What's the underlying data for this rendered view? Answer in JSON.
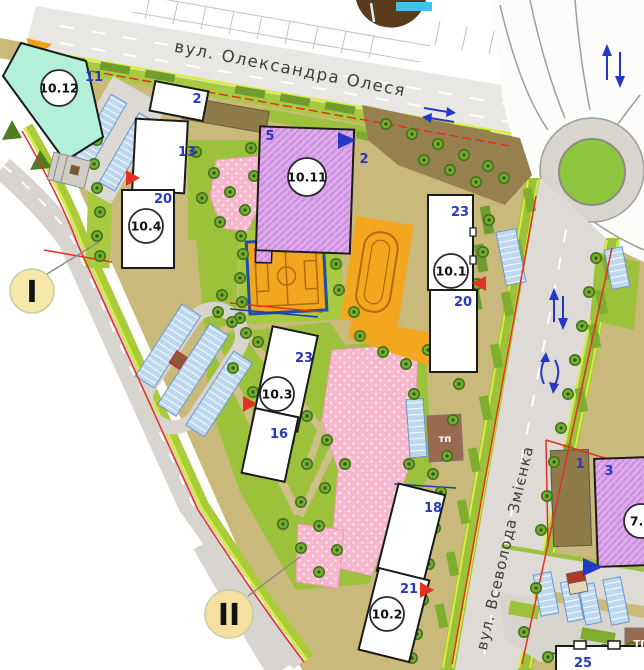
{
  "streets": {
    "top": {
      "name": "вул. Олександра Олеся"
    },
    "right": {
      "name": "вул. Всеволода Змієнка"
    }
  },
  "buildings": [
    {
      "id": "10.12",
      "floors": [
        "11"
      ]
    },
    {
      "id": "10.4",
      "floors": [
        "2",
        "13",
        "20"
      ]
    },
    {
      "id": "10.11",
      "floors": [
        "5",
        "2"
      ]
    },
    {
      "id": "10.1",
      "floors": [
        "23",
        "20"
      ]
    },
    {
      "id": "10.3",
      "floors": [
        "23",
        "16"
      ]
    },
    {
      "id": "10.2",
      "floors": [
        "18",
        "21"
      ]
    },
    {
      "id": "7.1",
      "floors": [
        "3"
      ]
    },
    {
      "id": "",
      "floors": [
        "1"
      ]
    },
    {
      "id": "",
      "floors": [
        "25"
      ]
    }
  ],
  "zones": [
    {
      "label": "I"
    },
    {
      "label": "II"
    }
  ],
  "facilities": {
    "substation_small": "тп",
    "substation_edge": "ТП"
  },
  "legend_colors": {
    "site_background": "#c9ba7c",
    "road_gray": "#dedbd6",
    "lawn_green": "#9cc13a",
    "hedge_green": "#6f9c2c",
    "playground_pink": "#f6b6cc",
    "building_purple": "#dfa9ec",
    "building_teal": "#b2f0da",
    "sports_field_orange": "#f2a71f",
    "parking_blue": "#bdd7ee",
    "boundary_red_line": "#e23025",
    "utility_blue_line": "#1d3f9e",
    "floor_number_blue": "#2737c0",
    "zone_circle_cream": "#f6e7ab",
    "roundabout_green": "#8dc63f"
  }
}
